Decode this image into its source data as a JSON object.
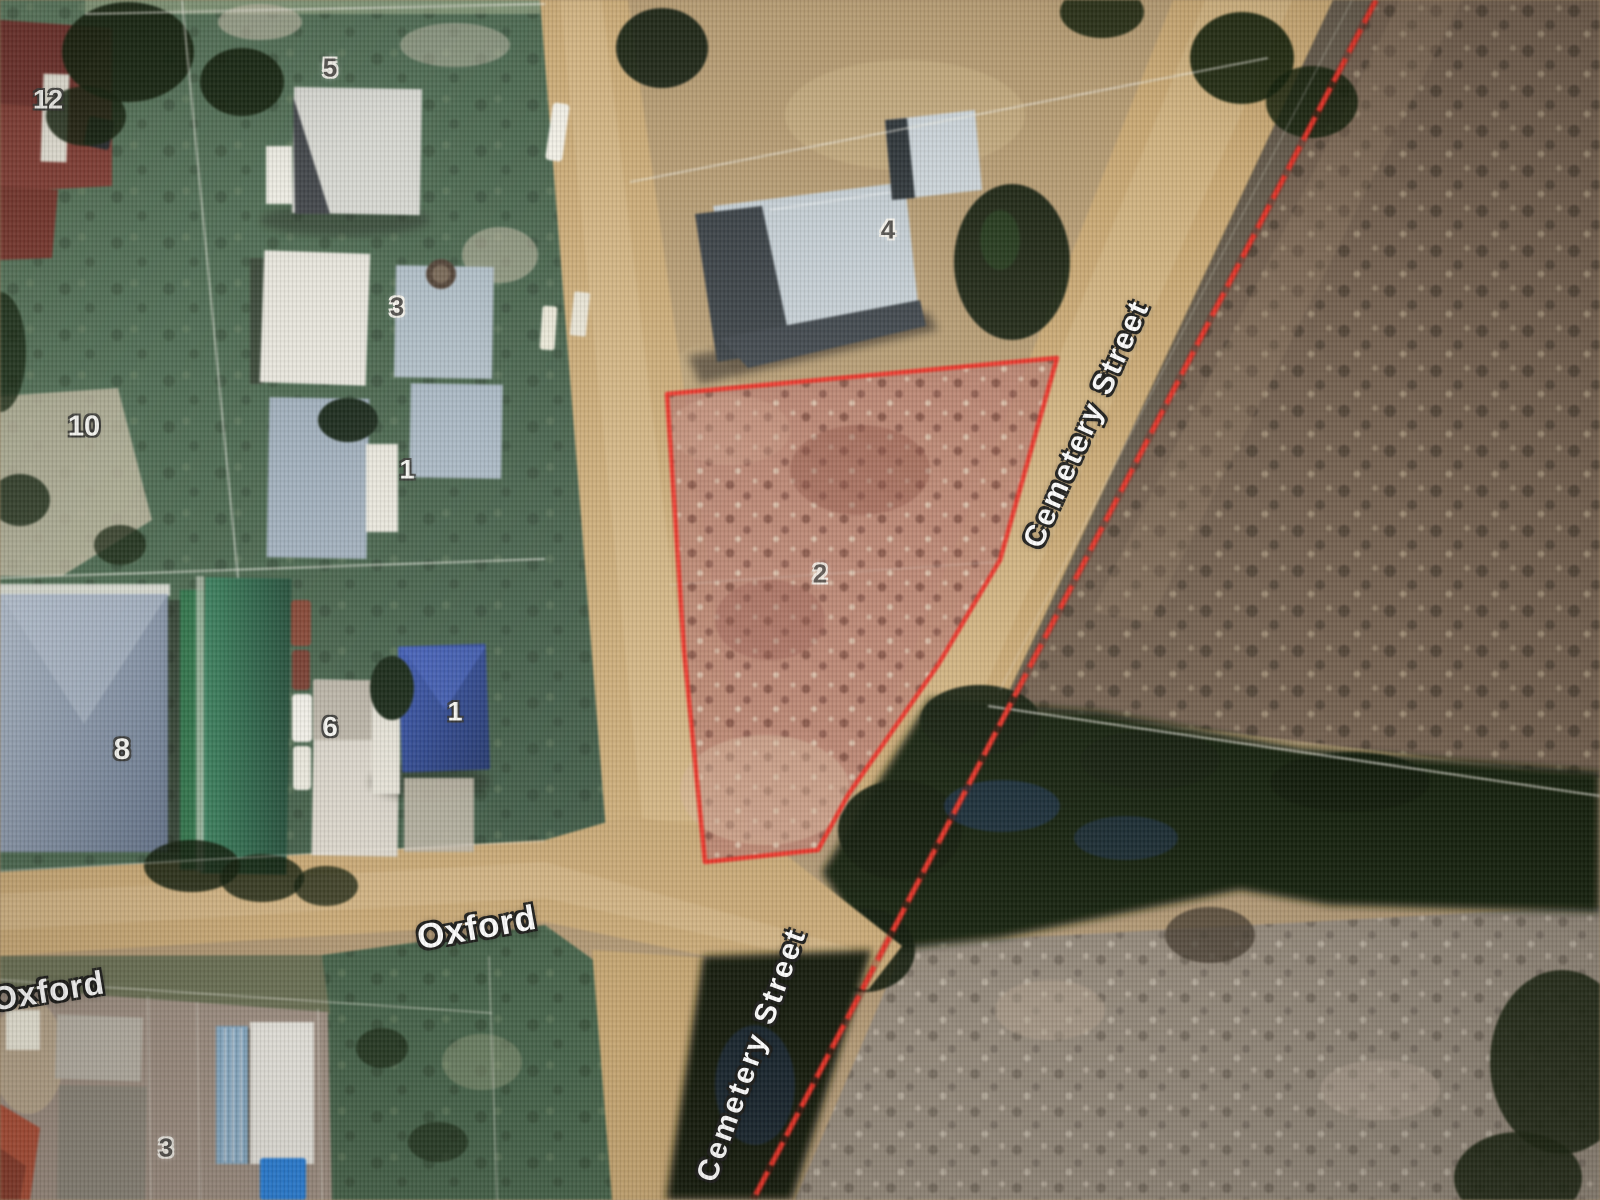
{
  "map": {
    "view_type": "satellite cadastral view",
    "selected_parcel": {
      "label": "2",
      "outline_color": "#f23428",
      "fill_tint": "#bd8472"
    },
    "boundary_line_color": "#ea3226",
    "parcel_labels": [
      {
        "text": "12"
      },
      {
        "text": "5"
      },
      {
        "text": "3"
      },
      {
        "text": "10"
      },
      {
        "text": "1"
      },
      {
        "text": "4"
      },
      {
        "text": "2"
      },
      {
        "text": "8"
      },
      {
        "text": "6"
      },
      {
        "text": "1"
      },
      {
        "text": "3"
      }
    ],
    "street_labels": [
      {
        "text": "Oxford"
      },
      {
        "text": "Oxford"
      },
      {
        "text": "Cemetery Street"
      },
      {
        "text": "Cemetery Street"
      }
    ]
  }
}
